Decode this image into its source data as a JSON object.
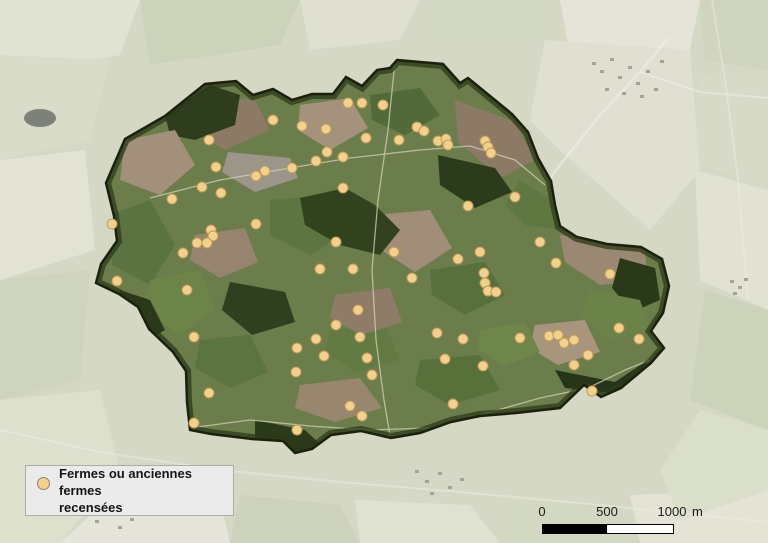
{
  "map": {
    "title": "Carte des fermes recensées sur fond de photographie aérienne",
    "legend": {
      "symbol": "farm-marker",
      "label_line1": "Fermes ou anciennes fermes",
      "label_line2": "recensées"
    },
    "scale_bar": {
      "ticks": [
        "0",
        "500",
        "1000"
      ],
      "unit": "m"
    },
    "colors": {
      "marker_fill": "#f2d08e",
      "marker_stroke": "#c19a58",
      "boundary": "#1a220e",
      "outside_base": "#d4d8c4",
      "commune_base": "#6b7d4a",
      "legend_bg": "#ebebeb"
    },
    "markers": {
      "name": "Fermes ou anciennes fermes recensées",
      "count": 83,
      "points": [
        [
          273,
          120
        ],
        [
          302,
          126
        ],
        [
          209,
          140
        ],
        [
          216,
          167
        ],
        [
          256,
          176
        ],
        [
          265,
          171
        ],
        [
          292,
          168
        ],
        [
          316,
          161
        ],
        [
          327,
          152
        ],
        [
          348,
          103
        ],
        [
          362,
          103
        ],
        [
          383,
          105
        ],
        [
          326,
          129
        ],
        [
          366,
          138
        ],
        [
          399,
          140
        ],
        [
          417,
          127
        ],
        [
          424,
          131
        ],
        [
          438,
          141
        ],
        [
          446,
          139
        ],
        [
          448,
          145
        ],
        [
          485,
          141
        ],
        [
          488,
          147
        ],
        [
          491,
          153
        ],
        [
          343,
          157
        ],
        [
          343,
          188
        ],
        [
          515,
          197
        ],
        [
          468,
          206
        ],
        [
          202,
          187
        ],
        [
          221,
          193
        ],
        [
          172,
          199
        ],
        [
          112,
          224
        ],
        [
          211,
          230
        ],
        [
          213,
          236
        ],
        [
          197,
          243
        ],
        [
          207,
          243
        ],
        [
          183,
          253
        ],
        [
          256,
          224
        ],
        [
          117,
          281
        ],
        [
          187,
          290
        ],
        [
          194,
          337
        ],
        [
          297,
          348
        ],
        [
          296,
          372
        ],
        [
          209,
          393
        ],
        [
          336,
          242
        ],
        [
          394,
          252
        ],
        [
          353,
          269
        ],
        [
          320,
          269
        ],
        [
          412,
          278
        ],
        [
          458,
          259
        ],
        [
          480,
          252
        ],
        [
          484,
          273
        ],
        [
          485,
          283
        ],
        [
          488,
          291
        ],
        [
          496,
          292
        ],
        [
          540,
          242
        ],
        [
          556,
          263
        ],
        [
          610,
          274
        ],
        [
          358,
          310
        ],
        [
          336,
          325
        ],
        [
          360,
          337
        ],
        [
          316,
          339
        ],
        [
          324,
          356
        ],
        [
          367,
          358
        ],
        [
          372,
          375
        ],
        [
          437,
          333
        ],
        [
          463,
          339
        ],
        [
          445,
          359
        ],
        [
          483,
          366
        ],
        [
          520,
          338
        ],
        [
          549,
          336
        ],
        [
          558,
          335
        ],
        [
          564,
          343
        ],
        [
          574,
          340
        ],
        [
          588,
          355
        ],
        [
          574,
          365
        ],
        [
          592,
          391
        ],
        [
          619,
          328
        ],
        [
          639,
          339
        ],
        [
          194,
          423
        ],
        [
          297,
          430
        ],
        [
          350,
          406
        ],
        [
          362,
          416
        ],
        [
          453,
          404
        ]
      ]
    }
  }
}
